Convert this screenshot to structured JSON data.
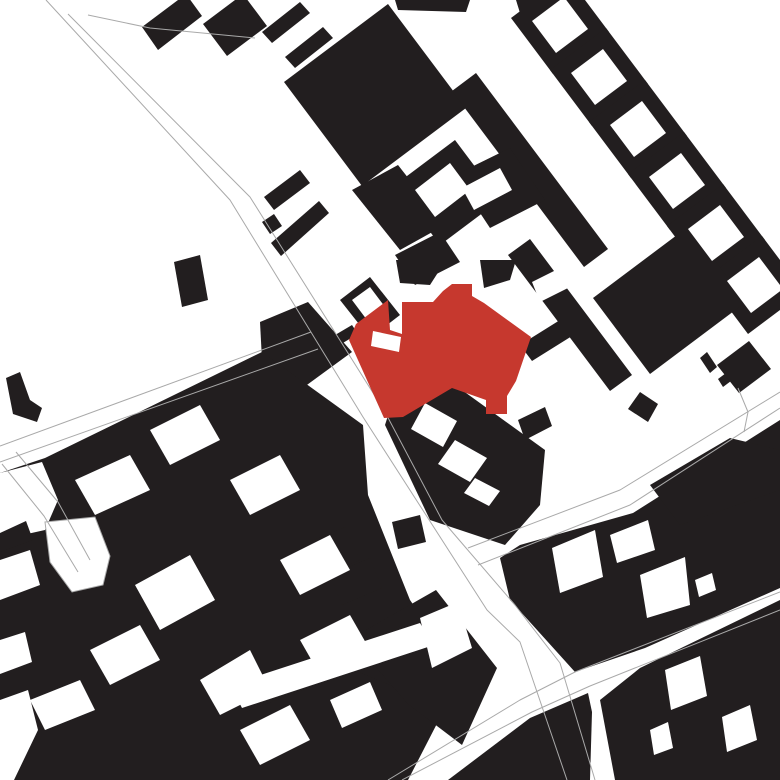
{
  "map": {
    "kind": "figure-ground-site-plan",
    "width": 780,
    "height": 780,
    "colors": {
      "background": "#ffffff",
      "building": "#221e1f",
      "highlight": "#c6382e",
      "street_line": "#a9a9a9"
    },
    "blocks": [
      {
        "points": "142,27 186,-6 202,16 158,50"
      },
      {
        "points": "203,24 243,-6 267,26 227,56"
      },
      {
        "points": "262,32 300,2 310,13 272,43"
      },
      {
        "points": "285,57 323,27 333,38 295,68"
      },
      {
        "points": "388,4 466,108 362,186 284,82"
      },
      {
        "points": "395,0 470,0 466,12 398,10"
      },
      {
        "points": "476,73 608,249 584,267 452,91"
      },
      {
        "points": "516,0 556,0 562,16 524,26"
      },
      {
        "points": "567,-24 609,32 553,74 511,18"
      },
      {
        "points": "606,28 648,84 592,126 550,70"
      },
      {
        "points": "645,80 687,136 631,178 589,122"
      },
      {
        "points": "684,132 726,188 670,230 628,174"
      },
      {
        "points": "723,184 765,240 709,282 667,226"
      },
      {
        "points": "762,236 804,292 748,334 706,278"
      },
      {
        "points": "264,197 300,170 310,183 274,210"
      },
      {
        "points": "271,243 319,201 329,213 281,256"
      },
      {
        "points": "262,222 274,214 282,226 270,234"
      },
      {
        "points": "352,190 398,165 445,225 400,250"
      },
      {
        "points": "395,185 455,140 500,200 440,245"
      },
      {
        "points": "395,255 440,232 460,262 415,285"
      },
      {
        "points": "455,175 510,148 545,200 490,228"
      },
      {
        "points": "340,300 370,277 400,315 370,338"
      },
      {
        "points": "330,338 352,325 358,334 336,347"
      },
      {
        "points": "260,322 308,302 352,352 300,390 262,360"
      },
      {
        "points": "174,262 200,255 208,300 182,307"
      },
      {
        "points": "6,378 20,372 30,400 42,408 37,422 13,414"
      },
      {
        "points": "45,458 262,352 363,425 368,495 410,600 448,655 420,676 390,780 0,780 0,473"
      },
      {
        "points": "246,712 354,670 445,708 408,780 246,780"
      },
      {
        "points": "366,630 436,590 497,668 462,745 408,704 368,658"
      },
      {
        "points": "302,545 345,527 360,560 317,578"
      },
      {
        "points": "330,575 370,558 382,588 342,605"
      },
      {
        "points": "392,522 420,515 426,542 398,549"
      },
      {
        "points": "393,400 455,385 545,450 540,505 505,545 430,520 385,425"
      },
      {
        "points": "518,420 545,407 552,426 525,440"
      },
      {
        "points": "530,239 632,375 610,391 508,255"
      },
      {
        "points": "520,345 560,320 572,336 532,361"
      },
      {
        "points": "689,226 746,302 650,374 593,298"
      },
      {
        "points": "700,358 707,352 717,367 710,373"
      },
      {
        "points": "718,379 726,373 731,381 723,387"
      },
      {
        "points": "749,341 771,369 739,393 717,365"
      },
      {
        "points": "640,392 658,404 648,422 628,409"
      },
      {
        "points": "500,558 520,545 633,513 780,420 780,588 645,648 575,672 510,600"
      },
      {
        "points": "650,485 730,438 780,450 780,490 680,525"
      },
      {
        "points": "448,780 530,718 588,693 592,712 590,780"
      },
      {
        "points": "600,700 640,668 780,600 780,780 615,780"
      },
      {
        "points": "396,260 446,260 430,285 400,283"
      },
      {
        "points": "480,260 516,260 510,280 484,288"
      }
    ],
    "courtyards": [
      {
        "points": "415,190 450,163 470,190 435,217"
      },
      {
        "points": "462,188 500,168 512,190 474,210"
      },
      {
        "points": "352,300 370,287 385,307 367,320"
      },
      {
        "points": "532,282 560,268 568,288 540,302"
      },
      {
        "points": "425,403 457,421 443,447 411,429"
      },
      {
        "points": "455,440 487,458 470,482 438,464"
      },
      {
        "points": "475,478 500,491 489,506 464,493"
      },
      {
        "points": "75,480 130,455 150,490 95,515"
      },
      {
        "points": "150,430 200,405 220,440 170,465"
      },
      {
        "points": "135,585 190,555 215,600 160,630"
      },
      {
        "points": "230,480 280,455 300,490 250,515"
      },
      {
        "points": "90,650 140,625 160,660 110,685"
      },
      {
        "points": "200,680 250,650 270,690 220,715"
      },
      {
        "points": "280,560 330,535 350,570 300,595"
      },
      {
        "points": "300,640 350,615 370,650 320,675"
      },
      {
        "points": "30,700 80,680 95,710 45,730"
      },
      {
        "points": "240,730 290,705 310,740 260,765"
      },
      {
        "points": "330,700 370,682 382,710 342,728"
      },
      {
        "points": "0,473 42,462 58,500 45,530 0,540"
      },
      {
        "points": "0,560 30,550 40,585 0,600"
      },
      {
        "points": "0,640 25,632 32,662 0,674"
      },
      {
        "points": "0,700 28,690 38,730 14,780 0,780"
      },
      {
        "points": "230,685 420,623 434,645 242,708"
      },
      {
        "points": "420,618 458,602 472,648 432,668"
      },
      {
        "points": "552,548 595,530 603,577 560,593"
      },
      {
        "points": "610,535 648,520 655,550 617,563"
      },
      {
        "points": "640,575 685,557 690,605 647,618"
      },
      {
        "points": "695,580 712,573 716,590 699,597"
      },
      {
        "points": "665,670 700,656 707,696 671,710"
      },
      {
        "points": "722,717 750,705 757,740 727,752"
      },
      {
        "points": "650,730 668,722 673,748 654,755"
      },
      {
        "points": "564,-3 588,29 556,53 532,21"
      },
      {
        "points": "603,49 627,81 595,105 571,73"
      },
      {
        "points": "642,101 666,133 634,157 610,125"
      },
      {
        "points": "681,153 705,185 673,209 649,177"
      },
      {
        "points": "720,205 744,237 712,261 688,229"
      },
      {
        "points": "759,257 783,289 751,313 727,281"
      }
    ],
    "blocks_overlay": [
      {
        "points": "0,533 26,521 33,540 0,552"
      }
    ],
    "outlined_courtyard": {
      "points": "45,522 95,517 110,556 103,585 72,592 50,562"
    },
    "streets": [
      {
        "points": "46,0 230,200 363,417 487,610 520,642 567,780"
      },
      {
        "points": "68,14 250,197 385,412 442,520 515,605 560,663 595,780"
      },
      {
        "points": "88,15 150,28 255,38"
      },
      {
        "points": "0,446 311,332"
      },
      {
        "points": "0,462 318,349"
      },
      {
        "points": "468,548 620,490 780,392"
      },
      {
        "points": "478,565 630,505 780,408"
      },
      {
        "points": "388,780 520,700 575,672 780,592"
      },
      {
        "points": "402,780 532,712 590,686 780,610"
      },
      {
        "points": "16,452 58,502 90,560"
      },
      {
        "points": "2,464 44,516 78,572"
      },
      {
        "points": "738,388 748,412 744,432"
      }
    ],
    "landmark": {
      "outline": "452,284 472,284 472,296 484,303 531,337 516,381 507,396 507,414 486,414 486,400 452,388 403,417 384,418 349,340 356,324 388,300 390,330 402,334 402,302 433,302 443,291",
      "notch": "373,331 401,337 399,352 371,346"
    }
  }
}
